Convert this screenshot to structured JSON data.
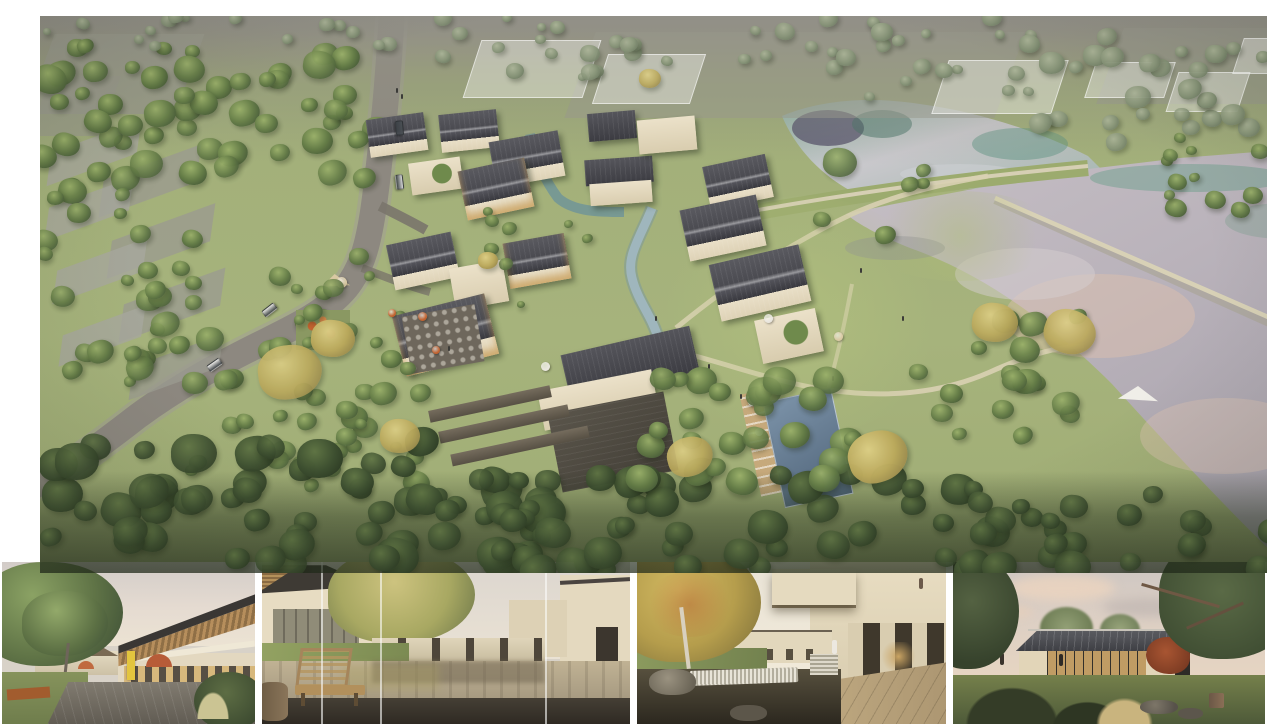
{
  "board": {
    "description": "Architectural presentation board: large aerial masterplan rendering of a lakeside village resort above a filmstrip of four eye-level renderings."
  },
  "main_render": {
    "description": "Aerial view of a village resort: a winding grey road with cars on the left, dense tree cover, grey farm plots in the upper-left, a cluster of pitched dark-roof houses with cream walls around a winding stream, a rectangular swimming pool with sun deck, terraced stone gardens, an outdoor dining terrace with orange umbrellas, a playground, translucent future-phase buildings at the top, lawns with walking paths, and two large reflective ponds separated by a grass dam and a thin diagonal causeway on the right.",
    "elements": {
      "road": "curving two-lane access road with cars and cyclists",
      "village": "cluster of gabled houses with charcoal roofs and cream walls along a stream",
      "pool": "dark blue lap pool with timber deck, loungers and white umbrellas",
      "ponds": "upper teal pond and large silver-pink pond split by grass dam and diagonal causeway",
      "terraces": "stepped stone garden walls below the main hall",
      "dining_terrace": "plaza with tables and orange umbrellas",
      "playground": "small playground with orange equipment and a beige shade sail",
      "ghost_buildings": "translucent white future-phase volumes at the top",
      "farm_plots": "grey polygonal plots in the upper-left",
      "forest": "dense green tree canopy on the left and along the bottom edge"
    }
  },
  "thumbnails": [
    {
      "id": "street-plaza",
      "description": "Eye-level view of a retail lane: two-storey building with a tilted timber-rafter roof and glass front, yellow shop sign, orange cafe umbrellas, people seated on a grey paver plaza, a large green tree and lawn with a corten planter on the left, pale pink-grey sky."
    },
    {
      "id": "bench-pond-courtyard",
      "description": "Courtyard with a shallow reflecting pond: wooden slat bench and log stool on dark stone in the foreground, grassy bank and cream two-storey buildings with glass walls on the left, building cluster with balconies on the right, a large yellow-green tree, thin vertical glass joints crossing the image."
    },
    {
      "id": "waterfall-courtyard",
      "description": "Courtyard pond with a stone weir waterfall in the foreground, autumn tree with pale trunk on the left, cream buildings with glass bases, a cantilevered balcony with a person standing on the upper right, deep shaded colonnade and warm interior glow, sandstone terrace in the lower right."
    },
    {
      "id": "dusk-pavilion",
      "description": "Single-storey pavilion at dusk: low dark hip roof with bright ridge, fully glazed warm-lit front, timber-raftered side wing, red maple beside it, lawn with dark grass tufts, beige grasses, rocks and a stump in the foreground, large trees framing both sides under a pink-grey cloudy sky."
    }
  ],
  "palette": {
    "canopy_dark": "#2c3a23",
    "tree_green": "#637b46",
    "tree_light": "#9ab06a",
    "tree_sage": "#879478",
    "tree_yellow": "#bba95c",
    "grass": "#a5b27b",
    "grass_bright": "#b3c187",
    "field_gray": "#98988c",
    "road": "#8d8880",
    "path": "#d9d0b3",
    "water_teal": "#7fae9e",
    "water_navy": "#4b4663",
    "water_silver": "#c3bcc2",
    "water_pink": "#e0c2ad",
    "pool_dark": "#4f6378",
    "pool_light": "#7c93a9",
    "deck": "#c6a97b",
    "roof_dark": "#3c3c42",
    "roof_slate": "#55555b",
    "wall_cream": "#e9dfc7",
    "stone": "#555046",
    "umbrella_orange": "#c2622f",
    "umbrella_white": "#e9e6de",
    "sky_pale": "#ded6cd",
    "sky_pink": "#e7d2c0"
  }
}
